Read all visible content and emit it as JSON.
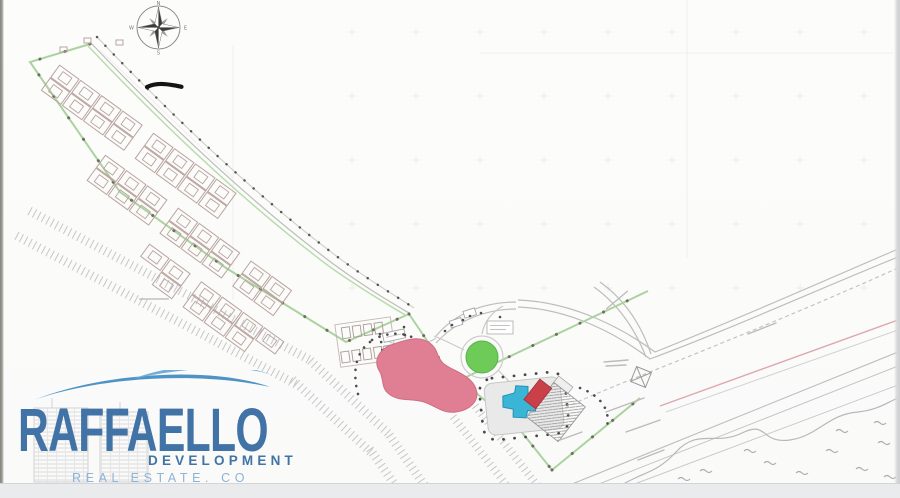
{
  "brand": {
    "name": "RAFFAELLO",
    "division": "DEVELOPMENT",
    "tagline": "REAL ESTATE. CO"
  },
  "compass": {
    "north": "N",
    "east": "E",
    "south": "S",
    "west": "W"
  },
  "colors": {
    "lagoon_pink": "#e07f93",
    "lagoon_edge": "#cf6d84",
    "pool_blue": "#3ab5d6",
    "lawn_green": "#6ecb58",
    "boundary_green": "#abd39f",
    "building_red": "#c94048",
    "survey_pink_line": "#dfa7ae",
    "brand_blue": "#4273a6",
    "brand_light_blue": "#8cb3d8"
  }
}
